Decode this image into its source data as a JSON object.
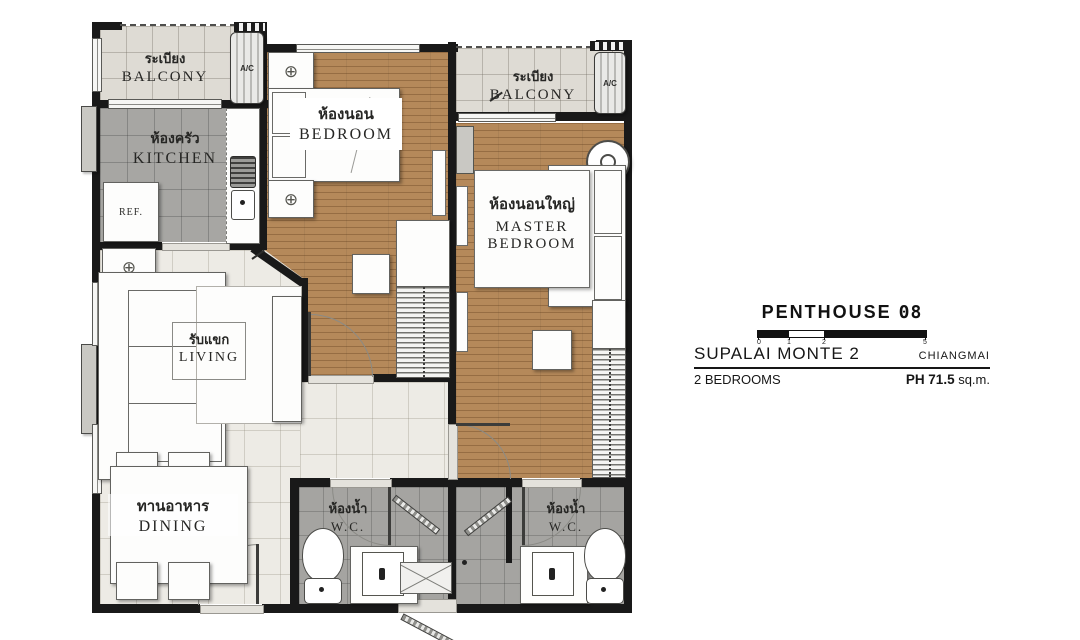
{
  "rooms": {
    "balcony": {
      "th": "ระเบียง",
      "en": "BALCONY"
    },
    "kitchen": {
      "th": "ห้องครัว",
      "en": "KITCHEN"
    },
    "bedroom": {
      "th": "ห้องนอน",
      "en": "BEDROOM"
    },
    "master": {
      "th": "ห้องนอนใหญ่",
      "en1": "MASTER",
      "en2": "BEDROOM"
    },
    "living": {
      "th": "รับแขก",
      "en": "LIVING"
    },
    "dining": {
      "th": "ทานอาหาร",
      "en": "DINING"
    },
    "wc": {
      "th": "ห้องน้ำ",
      "en": "W.C."
    }
  },
  "fixtures": {
    "fridge": "REF.",
    "ac": "A/C"
  },
  "info_panel": {
    "title": "PENTHOUSE",
    "unit_number": "08",
    "project": "SUPALAI MONTE 2",
    "city": "CHIANGMAI",
    "bedrooms": "2 BEDROOMS",
    "area_label": "PH",
    "area_value": "71.5",
    "area_unit": "sq.m.",
    "scale_ticks": [
      "0",
      "1",
      "2",
      "5"
    ]
  },
  "colors": {
    "wall": "#191919",
    "wood_floor": "#b5895a",
    "balcony_tile": "#dedbd4",
    "kitchen_tile": "#a7a6a3",
    "wc_tile": "#a5a4a1",
    "living_tile": "#edebe5"
  }
}
